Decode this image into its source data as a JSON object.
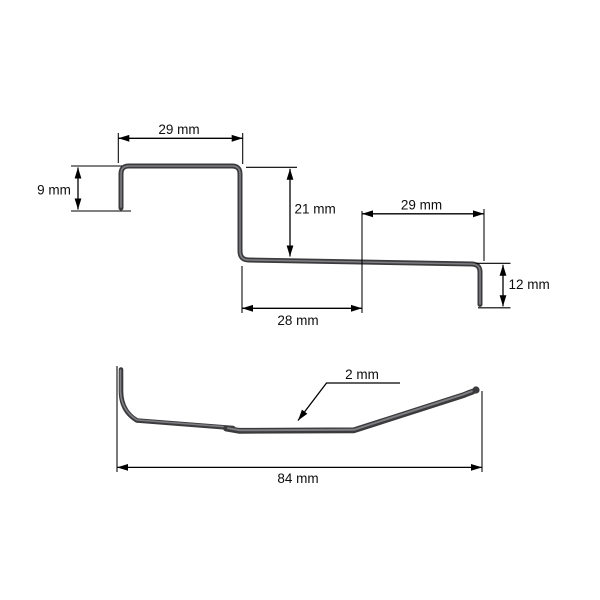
{
  "colors": {
    "background": "#ffffff",
    "line": "#000000",
    "wire_base": "#3b3b3d",
    "wire_highlight": "#8b8b8f"
  },
  "top_view": {
    "top_left_width": "29 mm",
    "left_height": "9 mm",
    "middle_height": "21 mm",
    "bottom_middle_width": "28 mm",
    "top_right_width": "29 mm",
    "right_height": "12 mm"
  },
  "side_view": {
    "wire_diameter": "2 mm",
    "overall_length": "84 mm"
  }
}
